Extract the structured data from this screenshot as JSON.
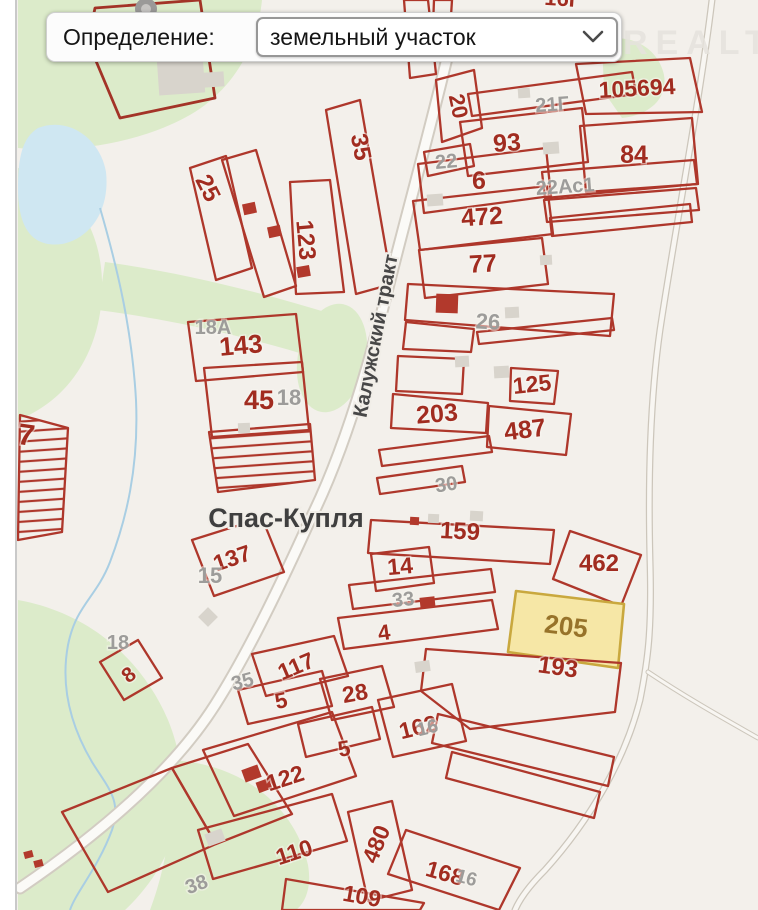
{
  "controls": {
    "definition_label": "Определение:",
    "definition_value": "земельный участок"
  },
  "watermark": "ONREALT",
  "map": {
    "place_label": "Спас-Купля",
    "road_label": "Калужский тракт",
    "colors": {
      "parcel_stroke": "#ae372b",
      "parcel_label": "#a12c20",
      "address_label": "#9d9c9a",
      "selected_fill": "#f6e7a6",
      "selected_stroke": "#c9a83e",
      "selected_label": "#97732a",
      "green_area": "#dcebca",
      "water": "#cfe7f2",
      "background": "#f3f0eb"
    },
    "parcels": [
      {
        "kind": "thick",
        "pts": "95,8 200,0 215,98 120,118 88,42"
      },
      {
        "kind": "red",
        "pts": "190,168 226,156 252,268 216,280"
      },
      {
        "kind": "red",
        "pts": "222,160 256,150 296,286 264,297"
      },
      {
        "kind": "red",
        "pts": "290,182 330,180 344,292 296,294"
      },
      {
        "kind": "red",
        "pts": "326,110 360,100 392,284 356,294"
      },
      {
        "kind": "red",
        "pts": "404,0 428,0 436,74 410,78"
      },
      {
        "kind": "red",
        "pts": "434,0 452,0 449,48 432,52"
      },
      {
        "kind": "red",
        "pts": "188,322 296,314 303,372 196,381"
      },
      {
        "kind": "red",
        "pts": "204,368 302,362 309,430 212,437"
      },
      {
        "kind": "hatch",
        "pts": "209,432 310,424 315,480 218,492"
      },
      {
        "kind": "red",
        "pts": "192,540 262,518 284,572 214,596"
      },
      {
        "kind": "red",
        "pts": "100,662 138,640 162,678 124,700"
      },
      {
        "kind": "hatch",
        "pts": "20,415 68,428 62,532 18,540"
      },
      {
        "kind": "red",
        "pts": "62,812 172,768 216,844 108,892"
      },
      {
        "kind": "red",
        "pts": "172,768 248,744 292,814 216,844"
      },
      {
        "kind": "red",
        "pts": "436,80 474,70 482,128 442,142"
      },
      {
        "kind": "red",
        "pts": "468,94 632,72 636,94 472,116"
      },
      {
        "kind": "red",
        "pts": "576,64 690,58 702,112 586,114"
      },
      {
        "kind": "red",
        "pts": "460,122 582,108 588,162 468,176"
      },
      {
        "kind": "red",
        "pts": "580,126 692,118 698,184 586,192"
      },
      {
        "kind": "red",
        "pts": "424,152 470,144 474,166 428,176"
      },
      {
        "kind": "red",
        "pts": "418,164 546,148 551,196 424,213"
      },
      {
        "kind": "red",
        "pts": "542,172 694,160 697,184 545,198"
      },
      {
        "kind": "red",
        "pts": "544,200 696,188 699,210 547,222"
      },
      {
        "kind": "red",
        "pts": "413,201 547,186 553,234 420,250"
      },
      {
        "kind": "red",
        "pts": "550,218 690,204 692,222 552,236"
      },
      {
        "kind": "red",
        "pts": "419,250 542,238 548,284 425,298"
      },
      {
        "kind": "red",
        "pts": "408,284 614,294 610,336 405,320"
      },
      {
        "kind": "red",
        "pts": "406,322 474,329 471,352 403,349"
      },
      {
        "kind": "red",
        "pts": "477,332 612,318 614,330 479,344"
      },
      {
        "kind": "red",
        "pts": "398,356 464,359 462,394 396,391"
      },
      {
        "kind": "red",
        "pts": "511,368 558,371 554,404 510,401"
      },
      {
        "kind": "red",
        "pts": "393,394 488,403 486,433 391,428"
      },
      {
        "kind": "red",
        "pts": "489,406 571,414 566,455 487,447"
      },
      {
        "kind": "red",
        "pts": "379,450 489,436 492,452 382,466"
      },
      {
        "kind": "red",
        "pts": "377,478 462,466 465,482 380,494"
      },
      {
        "kind": "red",
        "pts": "371,520 554,530 550,564 368,553"
      },
      {
        "kind": "red",
        "pts": "570,531 641,555 621,606 553,579"
      },
      {
        "kind": "red",
        "pts": "371,554 429,547 434,583 376,591"
      },
      {
        "kind": "red",
        "pts": "349,585 491,569 495,592 353,609"
      },
      {
        "kind": "red",
        "pts": "338,618 492,600 498,629 344,649"
      },
      {
        "kind": "sel",
        "pts": "516,591 624,604 618,668 508,652"
      },
      {
        "kind": "red",
        "pts": "426,649 621,663 615,712 470,729 421,691"
      },
      {
        "kind": "red",
        "pts": "252,654 334,636 348,676 266,696"
      },
      {
        "kind": "red",
        "pts": "320,679 382,666 394,707 332,720"
      },
      {
        "kind": "red",
        "pts": "238,690 322,671 332,706 248,724"
      },
      {
        "kind": "red",
        "pts": "378,700 452,684 466,741 393,757"
      },
      {
        "kind": "red",
        "pts": "298,724 372,707 380,739 306,757"
      },
      {
        "kind": "red",
        "pts": "203,750 332,712 356,776 234,816"
      },
      {
        "kind": "red",
        "pts": "198,830 332,794 347,841 213,879"
      },
      {
        "kind": "red",
        "pts": "348,812 392,801 412,890 368,901"
      },
      {
        "kind": "red",
        "pts": "406,830 520,868 499,910 388,874"
      },
      {
        "kind": "red",
        "pts": "286,879 424,903 420,910 282,910"
      },
      {
        "kind": "red",
        "pts": "438,714 614,757 608,786 432,743"
      },
      {
        "kind": "red",
        "pts": "452,752 600,792 594,818 446,778"
      }
    ],
    "buildings": [
      {
        "kind": "gray",
        "x": 158,
        "y": 58,
        "w": 46,
        "h": 36,
        "r": -4
      },
      {
        "kind": "gray",
        "x": 204,
        "y": 72,
        "w": 20,
        "h": 15,
        "r": -4
      },
      {
        "kind": "gray",
        "x": 543,
        "y": 142,
        "w": 16,
        "h": 12,
        "r": -4
      },
      {
        "kind": "gray",
        "x": 518,
        "y": 88,
        "w": 12,
        "h": 10,
        "r": -4
      },
      {
        "kind": "gray",
        "x": 427,
        "y": 194,
        "w": 16,
        "h": 12,
        "r": -4
      },
      {
        "kind": "gray",
        "x": 505,
        "y": 307,
        "w": 14,
        "h": 11,
        "r": -3
      },
      {
        "kind": "gray",
        "x": 540,
        "y": 255,
        "w": 12,
        "h": 10,
        "r": -3
      },
      {
        "kind": "gray",
        "x": 494,
        "y": 366,
        "w": 15,
        "h": 12,
        "r": -3
      },
      {
        "kind": "gray",
        "x": 455,
        "y": 356,
        "w": 14,
        "h": 11,
        "r": -3
      },
      {
        "kind": "gray",
        "x": 238,
        "y": 423,
        "w": 12,
        "h": 10,
        "r": -2
      },
      {
        "kind": "gray",
        "x": 206,
        "y": 831,
        "w": 18,
        "h": 13,
        "r": -20
      },
      {
        "kind": "gray",
        "x": 415,
        "y": 661,
        "w": 15,
        "h": 11,
        "r": -8
      },
      {
        "kind": "gray",
        "x": 470,
        "y": 511,
        "w": 13,
        "h": 10,
        "r": 3
      },
      {
        "kind": "gray",
        "x": 428,
        "y": 514,
        "w": 11,
        "h": 9,
        "r": 3
      },
      {
        "kind": "gray",
        "x": 201,
        "y": 610,
        "w": 14,
        "h": 14,
        "r": 45
      },
      {
        "kind": "red",
        "x": 243,
        "y": 203,
        "w": 13,
        "h": 11,
        "r": -12
      },
      {
        "kind": "red",
        "x": 268,
        "y": 226,
        "w": 13,
        "h": 11,
        "r": -12
      },
      {
        "kind": "red",
        "x": 297,
        "y": 266,
        "w": 13,
        "h": 11,
        "r": -10
      },
      {
        "kind": "red",
        "x": 436,
        "y": 294,
        "w": 22,
        "h": 19,
        "r": 2
      },
      {
        "kind": "red",
        "x": 410,
        "y": 517,
        "w": 9,
        "h": 8,
        "r": 3
      },
      {
        "kind": "red",
        "x": 420,
        "y": 597,
        "w": 15,
        "h": 11,
        "r": -6
      },
      {
        "kind": "red",
        "x": 243,
        "y": 767,
        "w": 17,
        "h": 13,
        "r": -20
      },
      {
        "kind": "red",
        "x": 257,
        "y": 780,
        "w": 14,
        "h": 11,
        "r": -20
      },
      {
        "kind": "red",
        "x": 24,
        "y": 851,
        "w": 9,
        "h": 7,
        "r": -15
      },
      {
        "kind": "red",
        "x": 34,
        "y": 860,
        "w": 9,
        "h": 7,
        "r": -15
      }
    ],
    "labels": [
      {
        "kind": "red",
        "t": "105694",
        "x": 637,
        "y": 88,
        "r": -3,
        "s": 23
      },
      {
        "kind": "red",
        "t": "16Г",
        "x": 563,
        "y": -2,
        "r": 4,
        "s": 22
      },
      {
        "kind": "red",
        "t": "20",
        "x": 459,
        "y": 106,
        "r": 78,
        "s": 22
      },
      {
        "kind": "red",
        "t": "93",
        "x": 507,
        "y": 143,
        "r": -4,
        "s": 25
      },
      {
        "kind": "red",
        "t": "84",
        "x": 634,
        "y": 155,
        "r": 0,
        "s": 25
      },
      {
        "kind": "red",
        "t": "6",
        "x": 479,
        "y": 181,
        "r": 0,
        "s": 25
      },
      {
        "kind": "red",
        "t": "472",
        "x": 482,
        "y": 217,
        "r": -4,
        "s": 25
      },
      {
        "kind": "red",
        "t": "77",
        "x": 483,
        "y": 264,
        "r": -3,
        "s": 25
      },
      {
        "kind": "red",
        "t": "25",
        "x": 208,
        "y": 188,
        "r": 63,
        "s": 24
      },
      {
        "kind": "red",
        "t": "123",
        "x": 306,
        "y": 240,
        "r": 85,
        "s": 24
      },
      {
        "kind": "red",
        "t": "35",
        "x": 361,
        "y": 147,
        "r": 79,
        "s": 24
      },
      {
        "kind": "red",
        "t": "143",
        "x": 241,
        "y": 346,
        "r": -5,
        "s": 26
      },
      {
        "kind": "red",
        "t": "45",
        "x": 259,
        "y": 401,
        "r": 0,
        "s": 27
      },
      {
        "kind": "red",
        "t": "203",
        "x": 437,
        "y": 414,
        "r": -5,
        "s": 25
      },
      {
        "kind": "red",
        "t": "487",
        "x": 525,
        "y": 430,
        "r": -7,
        "s": 25
      },
      {
        "kind": "red",
        "t": "125",
        "x": 532,
        "y": 384,
        "r": -6,
        "s": 23
      },
      {
        "kind": "red",
        "t": "159",
        "x": 460,
        "y": 531,
        "r": 3,
        "s": 24
      },
      {
        "kind": "red",
        "t": "462",
        "x": 599,
        "y": 563,
        "r": 0,
        "s": 24
      },
      {
        "kind": "red",
        "t": "14",
        "x": 400,
        "y": 566,
        "r": -5,
        "s": 23
      },
      {
        "kind": "red",
        "t": "4",
        "x": 384,
        "y": 632,
        "r": -8,
        "s": 22
      },
      {
        "kind": "red",
        "t": "193",
        "x": 558,
        "y": 667,
        "r": 8,
        "s": 24
      },
      {
        "kind": "red",
        "t": "117",
        "x": 296,
        "y": 666,
        "r": -23,
        "s": 23
      },
      {
        "kind": "red",
        "t": "28",
        "x": 355,
        "y": 693,
        "r": -10,
        "s": 23
      },
      {
        "kind": "red",
        "t": "5",
        "x": 281,
        "y": 700,
        "r": -12,
        "s": 22
      },
      {
        "kind": "red",
        "t": "162",
        "x": 418,
        "y": 727,
        "r": -14,
        "s": 23
      },
      {
        "kind": "red",
        "t": "5",
        "x": 344,
        "y": 748,
        "r": -10,
        "s": 22
      },
      {
        "kind": "red",
        "t": "8",
        "x": 128,
        "y": 674,
        "r": -38,
        "s": 21
      },
      {
        "kind": "red",
        "t": "122",
        "x": 285,
        "y": 778,
        "r": -18,
        "s": 23
      },
      {
        "kind": "red",
        "t": "110",
        "x": 294,
        "y": 852,
        "r": -18,
        "s": 23
      },
      {
        "kind": "red",
        "t": "480",
        "x": 376,
        "y": 844,
        "r": -68,
        "s": 23
      },
      {
        "kind": "red",
        "t": "168",
        "x": 445,
        "y": 873,
        "r": 16,
        "s": 23
      },
      {
        "kind": "red",
        "t": "109",
        "x": 362,
        "y": 896,
        "r": 10,
        "s": 23
      },
      {
        "kind": "red",
        "t": "137",
        "x": 232,
        "y": 558,
        "r": -19,
        "s": 23
      },
      {
        "kind": "red",
        "t": "7",
        "x": 26,
        "y": 437,
        "r": 8,
        "s": 30
      },
      {
        "kind": "sel",
        "t": "205",
        "x": 566,
        "y": 627,
        "r": 7,
        "s": 26
      },
      {
        "kind": "gray",
        "t": "21Г",
        "x": 552,
        "y": 103,
        "r": -4,
        "s": 20
      },
      {
        "kind": "gray",
        "t": "22",
        "x": 446,
        "y": 160,
        "r": -5,
        "s": 20
      },
      {
        "kind": "gray",
        "t": "22Ас1",
        "x": 565,
        "y": 185,
        "r": -4,
        "s": 20
      },
      {
        "kind": "gray",
        "t": "26",
        "x": 488,
        "y": 321,
        "r": 3,
        "s": 22
      },
      {
        "kind": "gray",
        "t": "18А",
        "x": 213,
        "y": 326,
        "r": 0,
        "s": 20
      },
      {
        "kind": "gray",
        "t": "18",
        "x": 289,
        "y": 397,
        "r": 0,
        "s": 22
      },
      {
        "kind": "gray",
        "t": "30",
        "x": 446,
        "y": 483,
        "r": -8,
        "s": 20
      },
      {
        "kind": "gray",
        "t": "15",
        "x": 210,
        "y": 575,
        "r": 0,
        "s": 22
      },
      {
        "kind": "gray",
        "t": "33",
        "x": 403,
        "y": 598,
        "r": -6,
        "s": 20
      },
      {
        "kind": "gray",
        "t": "35",
        "x": 242,
        "y": 680,
        "r": -15,
        "s": 20
      },
      {
        "kind": "gray",
        "t": "18",
        "x": 118,
        "y": 641,
        "r": 0,
        "s": 20
      },
      {
        "kind": "gray",
        "t": "16",
        "x": 427,
        "y": 726,
        "r": -14,
        "s": 19
      },
      {
        "kind": "gray",
        "t": "38",
        "x": 196,
        "y": 883,
        "r": -20,
        "s": 20
      },
      {
        "kind": "gray",
        "t": "16",
        "x": 467,
        "y": 876,
        "r": 15,
        "s": 19
      }
    ]
  }
}
